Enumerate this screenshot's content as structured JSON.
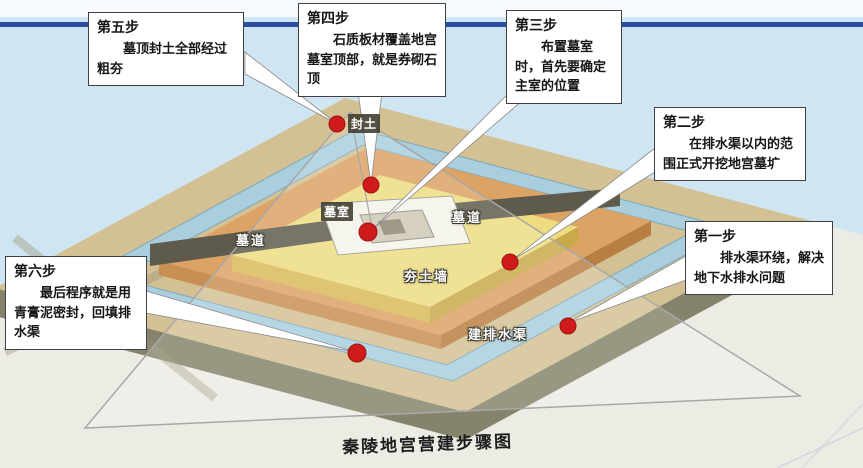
{
  "title": "秦陵地宫营建步骤图",
  "steps": [
    {
      "label": "第一步",
      "body": "排水渠环绕，解决地下水排水问题"
    },
    {
      "label": "第二步",
      "body": "在排水渠以内的范围正式开挖地宫墓圹"
    },
    {
      "label": "第三步",
      "body": "布置墓室时，首先要确定主室的位置"
    },
    {
      "label": "第四步",
      "body": "石质板材覆盖地宫墓室顶部，就是券砌石顶"
    },
    {
      "label": "第五步",
      "body": "墓顶封土全部经过粗夯"
    },
    {
      "label": "第六步",
      "body": "最后程序就是用青膏泥密封，回填排水渠"
    }
  ],
  "diagram_labels": {
    "mound_soil": "封土",
    "burial_chamber": "墓室",
    "tomb_passage_left": "墓道",
    "tomb_passage_right": "墓道",
    "rammed_earth_wall": "夯土墙",
    "drainage_channel": "建排水渠"
  },
  "colors": {
    "sky": "#cfe5f1",
    "rule_blue": "#2b4fa0",
    "ground_tan": "#d3c193",
    "base_olive": "#85836b",
    "channel_blue": "#a9cede",
    "terrace_orange": "#dca365",
    "terrace_yellow": "#eedd80",
    "inner_cream": "#f2ecca",
    "passage_dark": "#5e5a4c",
    "marker_red": "#cf1b1b"
  }
}
